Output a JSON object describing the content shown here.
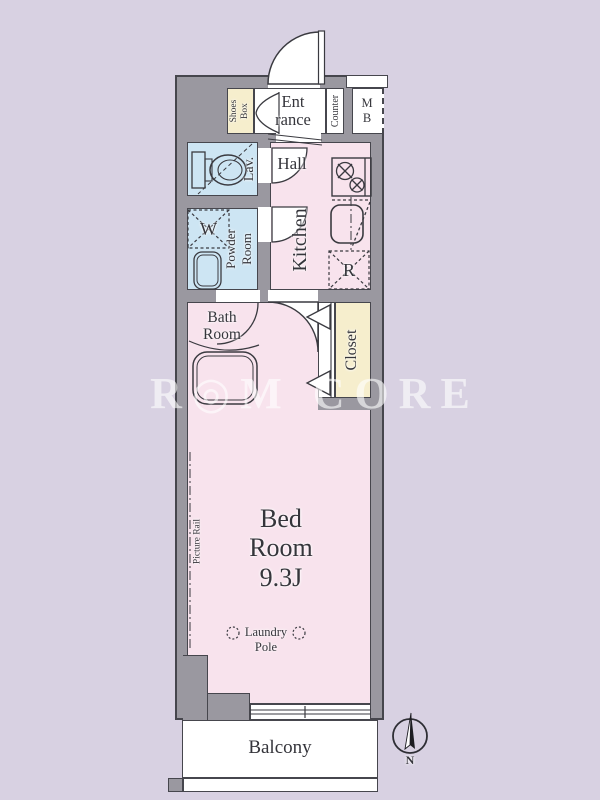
{
  "labels": {
    "shoes_box": "Shoes\nBox",
    "entrance": "Ent\nrance",
    "counter": "Counter",
    "meter_box": "M\nB",
    "lavatory": "Lav.",
    "hall": "Hall",
    "kitchen": "Kitchen",
    "powder_room": "Powder\nRoom",
    "washer": "W",
    "refrigerator": "R",
    "bath_room": "Bath\nRoom",
    "closet": "Closet",
    "bed_room": "Bed\nRoom\n9.3J",
    "picture_rail": "Picture Rail",
    "laundry": "Laundry",
    "pole": "Pole",
    "balcony": "Balcony",
    "north": "N"
  },
  "watermark": "R◎M CORE",
  "colors": {
    "background": "#d8d1e2",
    "wall": "#9a98a0",
    "room_pink": "#f8e3ed",
    "room_blue": "#cde5f3",
    "room_yellow": "#f6eecd",
    "line": "#46464d",
    "text": "#35353b",
    "watermark_color": "rgba(255,255,255,0.6)"
  }
}
